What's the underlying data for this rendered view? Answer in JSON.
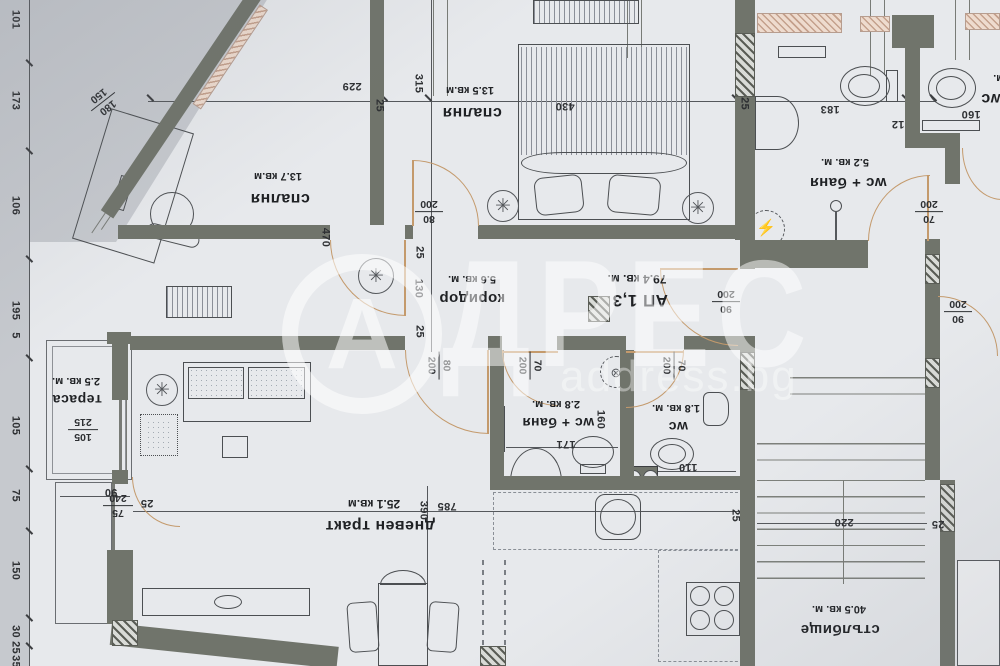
{
  "watermark": {
    "logo_letter": "А",
    "brand_rest": "ДРЕС",
    "site": "address.bg"
  },
  "rooms": {
    "bedroom1": {
      "name": "спалня",
      "area": "13.7 кв.м"
    },
    "bedroom2": {
      "name": "спалня",
      "area": "13.5 кв.м"
    },
    "bath_top": {
      "name": "wc + баня",
      "area": "5.2 кв. м."
    },
    "wc_right": {
      "name": "wc",
      "area": "кв. м."
    },
    "corridor": {
      "name": "коридор",
      "area": "5.6 кв. м."
    },
    "apartment": {
      "name": "АП 1,3",
      "area": "79.4 кв. м."
    },
    "bath_mid": {
      "name": "wc + баня",
      "area": "2.8 кв. м."
    },
    "wc_mid": {
      "name": "wc",
      "area": "1.8 кв. м."
    },
    "terrace": {
      "name": "тераса",
      "area": "2.5 кв. м."
    },
    "living": {
      "name": "дневен тракт",
      "area": "25.1 кв.м"
    },
    "stairs": {
      "name": "стълбище",
      "area": "40.5 кв. м."
    }
  },
  "dims": {
    "w229": "229",
    "w470": "470",
    "w315": "315",
    "w430": "430",
    "w183": "183",
    "w12": "12",
    "w160top": "160",
    "w160mid": "160",
    "w171": "171",
    "w110": "110",
    "w130": "130",
    "w220": "220",
    "w785": "785",
    "w390": "390",
    "w90terr": "90",
    "w240": "240",
    "w25_1": "25",
    "w25_2": "25",
    "w25_3": "25",
    "w25_4": "25",
    "w25_5": "25",
    "w25_6": "25",
    "w25_7": "25",
    "f180": {
      "t": "180",
      "b": "150"
    },
    "f105": {
      "t": "105",
      "b": "215"
    },
    "f75": {
      "t": "75",
      "b": "240"
    },
    "f80a": {
      "t": "80",
      "b": "200"
    },
    "f80b": {
      "t": "80",
      "b": "200"
    },
    "f70a": {
      "t": "70",
      "b": "200"
    },
    "f70b": {
      "t": "70",
      "b": "200"
    },
    "f70c": {
      "t": "70",
      "b": "200"
    },
    "f90a": {
      "t": "90",
      "b": "200"
    },
    "f90b": {
      "t": "90",
      "b": "200"
    }
  },
  "left_chain": [
    "101",
    "173",
    "106",
    "195",
    "5",
    "105",
    "75",
    "150",
    "30",
    "25",
    "35"
  ],
  "icons": {
    "chandelier": "✳",
    "electric": "⚡",
    "drain": "⊗"
  }
}
